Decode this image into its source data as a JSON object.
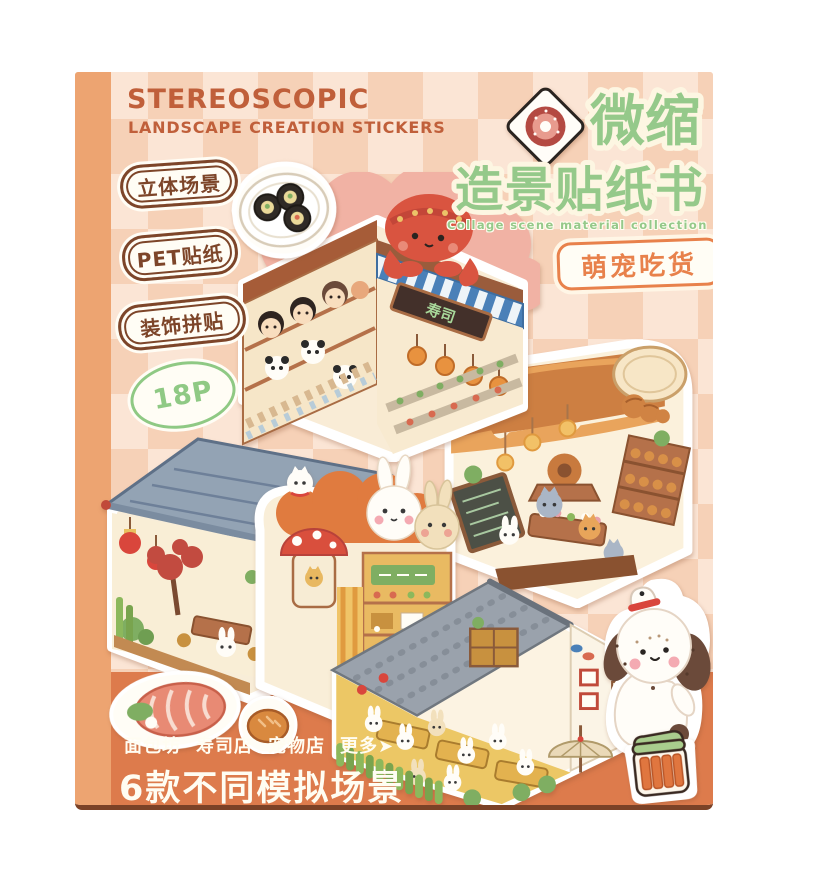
{
  "product": {
    "header": {
      "title": "STEREOSCOPIC",
      "subtitle": "LANDSCAPE CREATION STICKERS"
    },
    "feature_badges": [
      {
        "label": "立体场景"
      },
      {
        "label": "PET贴纸"
      },
      {
        "label": "装饰拼贴"
      }
    ],
    "page_count_badge": {
      "label": "18P"
    },
    "cn_title": {
      "line1": "微缩",
      "line2": "造景贴纸书",
      "caption": "Collage scene material collection book"
    },
    "theme_badge": {
      "label": "萌宠吃货"
    },
    "footer": {
      "categories": [
        "面包坊",
        "寿司店",
        "宠物店",
        "更多➤"
      ],
      "headline": "6款不同模拟场景"
    },
    "scenes": [
      {
        "id": "sushi-shop",
        "sign_text": "寿司",
        "description": "sushi shop with red octopus on striped awning, pandas and kids"
      },
      {
        "id": "teahouse",
        "description": "chinese teahouse with blue tiled roof, red lanterns and plants"
      },
      {
        "id": "pet-shop",
        "description": "mushroom-sign pet shop with big bunny heads under orange canopy"
      },
      {
        "id": "bakery",
        "description": "bakery with giant bread-loaf roof, croissant, bread shelves and cats"
      },
      {
        "id": "restaurant",
        "description": "bunny restaurant with grey tiled roof, yellow tables and bamboo hedge"
      }
    ],
    "stickers": [
      {
        "id": "sushi-plate",
        "description": "plate of three maki rolls"
      },
      {
        "id": "donut-diamond",
        "description": "donut on diamond tile"
      },
      {
        "id": "puppy",
        "description": "white puppy with brown ears and tiny hat"
      },
      {
        "id": "salmon-roll",
        "description": "salmon roll slice"
      },
      {
        "id": "bread-bun",
        "description": "small bread bun"
      },
      {
        "id": "snack-jar",
        "description": "jar with green lid and snack sticks"
      }
    ],
    "colors": {
      "spine": "#eda471",
      "checker_light": "#fbe5d5",
      "checker_dark": "#f6d1b7",
      "band": "#dd7b4c",
      "bottom_edge": "#7b4227",
      "title_brown": "#c05f3a",
      "title_green": "#95c98a",
      "badge_brown": "#7d4529",
      "badge_green": "#8fc984",
      "theme_orange": "#e8814b",
      "footer_text": "#fffdf2"
    }
  }
}
